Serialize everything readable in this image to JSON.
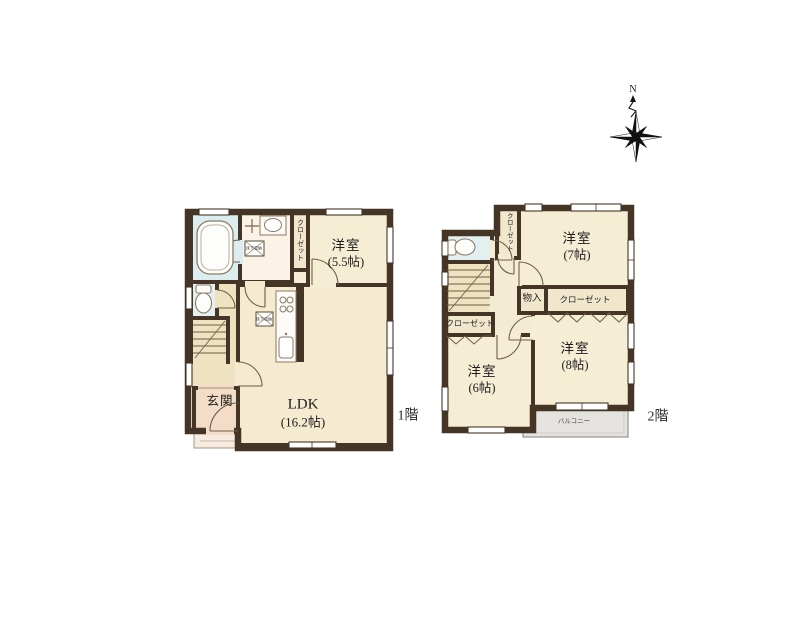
{
  "compass": {
    "north_label": "N"
  },
  "floor1": {
    "label": "1階",
    "rooms": {
      "western_room": {
        "name": "洋室",
        "size": "(5.5帖)"
      },
      "ldk": {
        "name": "LDK",
        "size": "(16.2帖)"
      },
      "entrance": {
        "name": "玄関"
      },
      "closet": {
        "name": "クローゼット"
      },
      "underfloor_storage_1": {
        "name": "床下収納"
      },
      "underfloor_storage_2": {
        "name": "床下収納"
      }
    }
  },
  "floor2": {
    "label": "2階",
    "rooms": {
      "western_room_7": {
        "name": "洋室",
        "size": "(7帖)"
      },
      "western_room_8": {
        "name": "洋室",
        "size": "(8帖)"
      },
      "western_room_6": {
        "name": "洋室",
        "size": "(6帖)"
      },
      "storage": {
        "name": "物入"
      },
      "closet_right": {
        "name": "クローゼット"
      },
      "closet_left": {
        "name": "クローゼット"
      },
      "closet_top": {
        "name": "クローゼット"
      },
      "balcony": {
        "name": "バルコニー"
      }
    }
  },
  "colors": {
    "wall": "#453527",
    "room_floor": "#f6edd5",
    "ldk_floor": "#f5ebd1",
    "hall_floor": "#efe2c0",
    "closet_floor": "#f0e7cd",
    "wet_floor": "#dcedf0",
    "entrance_floor": "#f3dcc8",
    "porch_floor": "#f7ebe0",
    "balcony_floor": "#e4e3df"
  }
}
